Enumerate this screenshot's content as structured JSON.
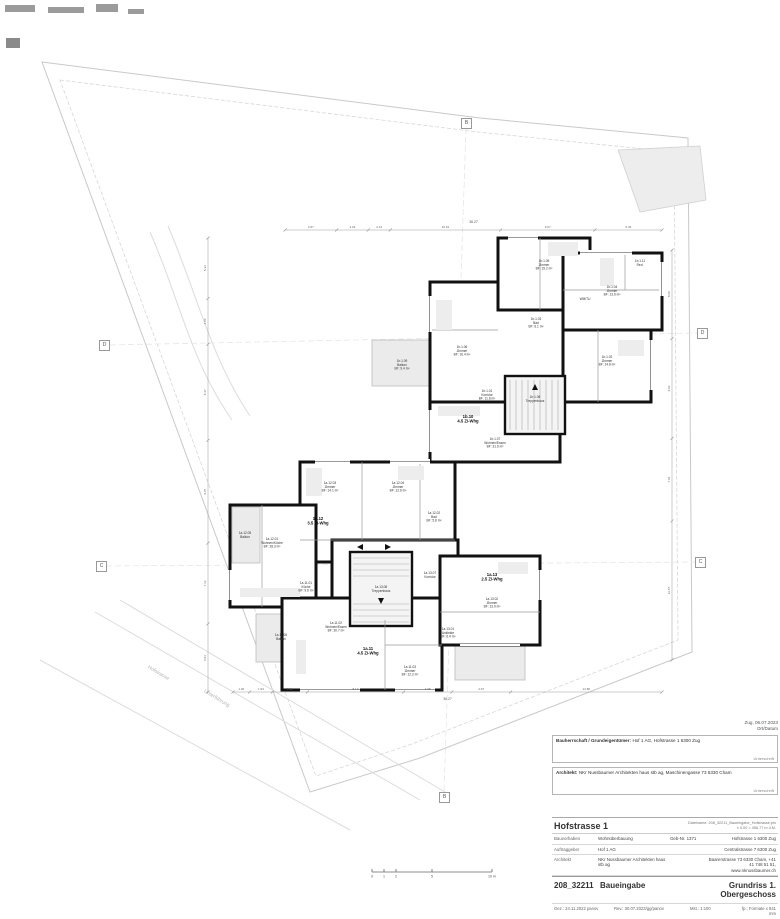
{
  "notes": {
    "date": "Zug, 06.07.2023",
    "date_caption": "Ort/Datum"
  },
  "signatures": [
    {
      "label": "Bauherrschaft / Grundeigentümer:",
      "value": "Hof 1 AG, Hofstrasse 1 6300 Zug",
      "caption": "Unterschrift"
    },
    {
      "label": "Architekt:",
      "value": "NKr Nussbaumer Architekten haus stb ag, Maschinengasse 73 6330 Cham",
      "caption": "Unterschrift"
    }
  ],
  "titleblock": {
    "project": "Hofstrasse 1",
    "file_line1": "Dateiname: 208_32211_Baueingabe_Hofstrasse.pln",
    "file_line2": "± 0.00 = 456.77 m ü.M.",
    "rows": [
      {
        "label": "Bauvorhaben",
        "value": "Wohnüberbauung",
        "extra": "Geb-Nr. 1371",
        "right": "Hofstrasse 1 6300 Zug"
      },
      {
        "label": "Auftraggeber",
        "value": "Hof 1 AG",
        "extra": "",
        "right": "Centralstrasse 7 6300 Zug"
      },
      {
        "label": "Architekt",
        "value": "NKr Nussbaumer Architekten haus stb ag",
        "extra": "",
        "right": "Baarerstrasse 73 6330 Cham, +41 41 748 51 51, www.nknussbaumer.ch"
      }
    ],
    "number": "208_32211",
    "phase": "Baueingabe",
    "sheet": "Grundriss 1. Obergeschoss",
    "meta": {
      "gez": "Gez.:  24.11.2022 panov",
      "rev": "Rev.:  30.07.2023/gg/panov",
      "mst": "Mst.:  1:100",
      "fp": "fp.:  Formate x 841 mm"
    }
  },
  "grid_markers": [
    {
      "label": "D"
    },
    {
      "label": "D"
    },
    {
      "label": "C"
    },
    {
      "label": "C"
    },
    {
      "label": "B"
    },
    {
      "label": "B"
    }
  ],
  "streets": [
    {
      "label": "Hofstrasse"
    },
    {
      "label": "Unterführung"
    }
  ],
  "scalebar": {
    "labels": [
      "0",
      "1",
      "2",
      "5",
      "10 m"
    ]
  },
  "plan": {
    "apartments": [
      {
        "x": 468,
        "y": 418,
        "tag": "1b.10",
        "type": "4.5 Zi-Whg"
      },
      {
        "x": 318,
        "y": 520,
        "tag": "1a.12",
        "type": "3.5 Zi-Whg"
      },
      {
        "x": 368,
        "y": 650,
        "tag": "1a.11",
        "type": "4.5 Zi-Whg"
      },
      {
        "x": 492,
        "y": 576,
        "tag": "1a.13",
        "type": "2.5 Zi-Whg"
      }
    ],
    "rooms": [
      {
        "x": 544,
        "y": 262,
        "lines": [
          "1b.1.05",
          "Zimmer",
          "BF: 15.2 m²"
        ]
      },
      {
        "x": 612,
        "y": 288,
        "lines": [
          "1b.1.04",
          "Zimmer",
          "BF: 13.6 m²"
        ]
      },
      {
        "x": 640,
        "y": 262,
        "lines": [
          "1b.1.11",
          "Red."
        ]
      },
      {
        "x": 585,
        "y": 300,
        "lines": [
          "WM/TU"
        ]
      },
      {
        "x": 607,
        "y": 358,
        "lines": [
          "1b.1.02",
          "Zimmer",
          "BF: 14.8 m²"
        ]
      },
      {
        "x": 536,
        "y": 320,
        "lines": [
          "1b.1.03",
          "Bad",
          "BF: 6.1 m²"
        ]
      },
      {
        "x": 462,
        "y": 348,
        "lines": [
          "1b.1.06",
          "Zimmer",
          "BF: 16.4 m²"
        ]
      },
      {
        "x": 487,
        "y": 392,
        "lines": [
          "1b.1.01",
          "Korridor",
          "BF: 11.8 m²"
        ]
      },
      {
        "x": 535,
        "y": 398,
        "lines": [
          "1b.1.08",
          "Treppenhaus"
        ]
      },
      {
        "x": 495,
        "y": 440,
        "lines": [
          "1b.1.07",
          "Wohnen/Essen",
          "BF: 31.6 m²"
        ]
      },
      {
        "x": 402,
        "y": 362,
        "lines": [
          "1b.1.09",
          "Balkon",
          "BF: 9.4 m²"
        ]
      },
      {
        "x": 330,
        "y": 484,
        "lines": [
          "1a.12.03",
          "Zimmer",
          "BF: 14.1 m²"
        ]
      },
      {
        "x": 398,
        "y": 484,
        "lines": [
          "1a.12.04",
          "Zimmer",
          "BF: 12.6 m²"
        ]
      },
      {
        "x": 434,
        "y": 514,
        "lines": [
          "1a.12.02",
          "Bad",
          "BF: 5.8 m²"
        ]
      },
      {
        "x": 272,
        "y": 540,
        "lines": [
          "1a.12.01",
          "Wohnen/Küche",
          "BF: 28.3 m²"
        ]
      },
      {
        "x": 245,
        "y": 534,
        "lines": [
          "1a.12.05",
          "Balkon"
        ]
      },
      {
        "x": 381,
        "y": 588,
        "lines": [
          "1a.13.08",
          "Treppenhaus"
        ]
      },
      {
        "x": 492,
        "y": 600,
        "lines": [
          "1a.13.02",
          "Zimmer",
          "BF: 13.9 m²"
        ]
      },
      {
        "x": 448,
        "y": 630,
        "lines": [
          "1a.13.01",
          "Ankleide",
          "BF: 6.4 m²"
        ]
      },
      {
        "x": 430,
        "y": 574,
        "lines": [
          "1a.13.07",
          "Korridor"
        ]
      },
      {
        "x": 306,
        "y": 584,
        "lines": [
          "1a.11.01",
          "Küche",
          "BF: 9.6 m²"
        ]
      },
      {
        "x": 336,
        "y": 624,
        "lines": [
          "1a.11.02",
          "Wohnen/Essen",
          "BF: 30.7 m²"
        ]
      },
      {
        "x": 281,
        "y": 636,
        "lines": [
          "1a.11.06",
          "Balkon"
        ]
      },
      {
        "x": 410,
        "y": 668,
        "lines": [
          "1a.11.03",
          "Zimmer",
          "BF: 12.2 m²"
        ]
      }
    ],
    "dims": {
      "top": {
        "total": "36.27",
        "values": [
          "4.97",
          "3.04",
          "2.12",
          "10.61",
          "9.07",
          "6.46"
        ]
      },
      "bottom": {
        "total": "36.27",
        "values": [
          "1.40",
          "1.93",
          "2.96",
          "8.13",
          "4.08",
          "4.97",
          "12.80"
        ]
      },
      "left": {
        "values": [
          "5.34",
          "4.04",
          "8.47",
          "9.07",
          "7.13",
          "6.01"
        ]
      },
      "right": {
        "values": [
          "8.00",
          "9.03",
          "7.46",
          "12.57"
        ]
      }
    }
  }
}
